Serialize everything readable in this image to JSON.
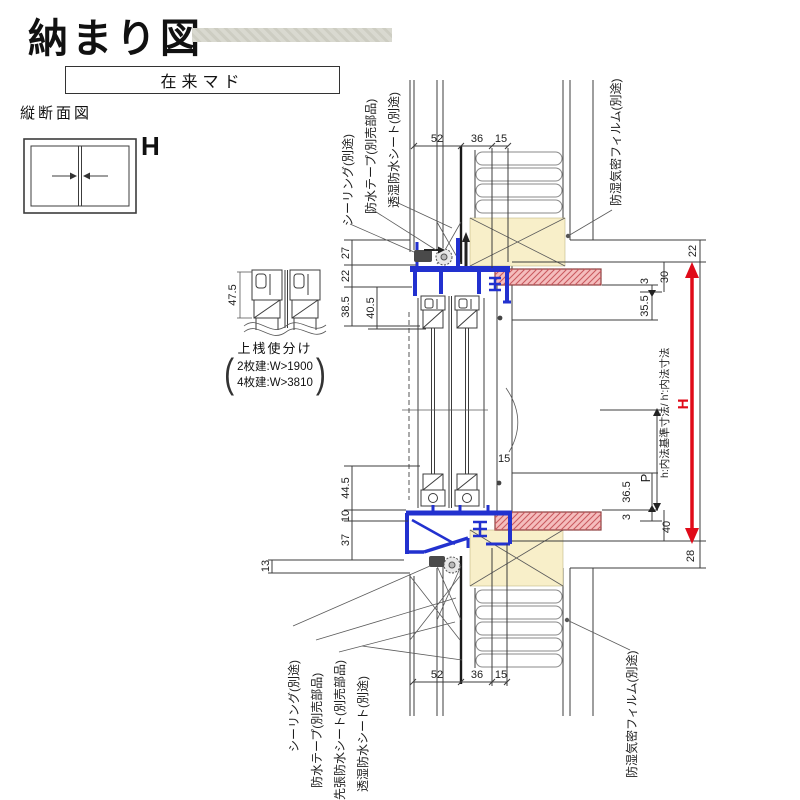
{
  "header": {
    "title": "納まり図",
    "window_type": "在来マド",
    "section_title": "縦断面図",
    "height_symbol": "H"
  },
  "upper_rail_note": {
    "title": "上桟使分け",
    "options": [
      {
        "label": "2枚建:W>1900"
      },
      {
        "label": "4枚建:W>3810"
      }
    ],
    "dim": "47.5"
  },
  "dims": {
    "top": [
      "52",
      "36",
      "15"
    ],
    "bottom": [
      "52",
      "36",
      "15"
    ],
    "left_top": [
      "27",
      "22",
      "38.5",
      "40.5"
    ],
    "left_bottom": [
      "44.5",
      "10",
      "37",
      "13"
    ],
    "center": "15",
    "right_top": [
      "22",
      "30",
      "3",
      "35.5"
    ],
    "right_bottom": [
      "36.5",
      "3",
      "40",
      "28"
    ],
    "p": "P",
    "h": "H",
    "h_note": "h:内法基準寸法/ h':内法寸法"
  },
  "callouts": {
    "top": [
      "シーリング(別途)",
      "防水テープ(別売部品)",
      "透湿防水シート(別途)",
      "防湿気密フィルム(別途)"
    ],
    "bottom": [
      "シーリング(別途)",
      "防水テープ(別売部品)",
      "先張防水シート(別売部品)",
      "透湿防水シート(別途)",
      "防湿気密フィルム(別途)"
    ]
  },
  "colors": {
    "frame_blue": "#2231cf",
    "dim_red": "#e00b19",
    "wood_fill": "#f8efc9",
    "casing_fill": "#f5bdbd",
    "casing_hatch": "#c9595f",
    "line": "#3c3c3c",
    "bar_gray": "#d9d9d0"
  }
}
